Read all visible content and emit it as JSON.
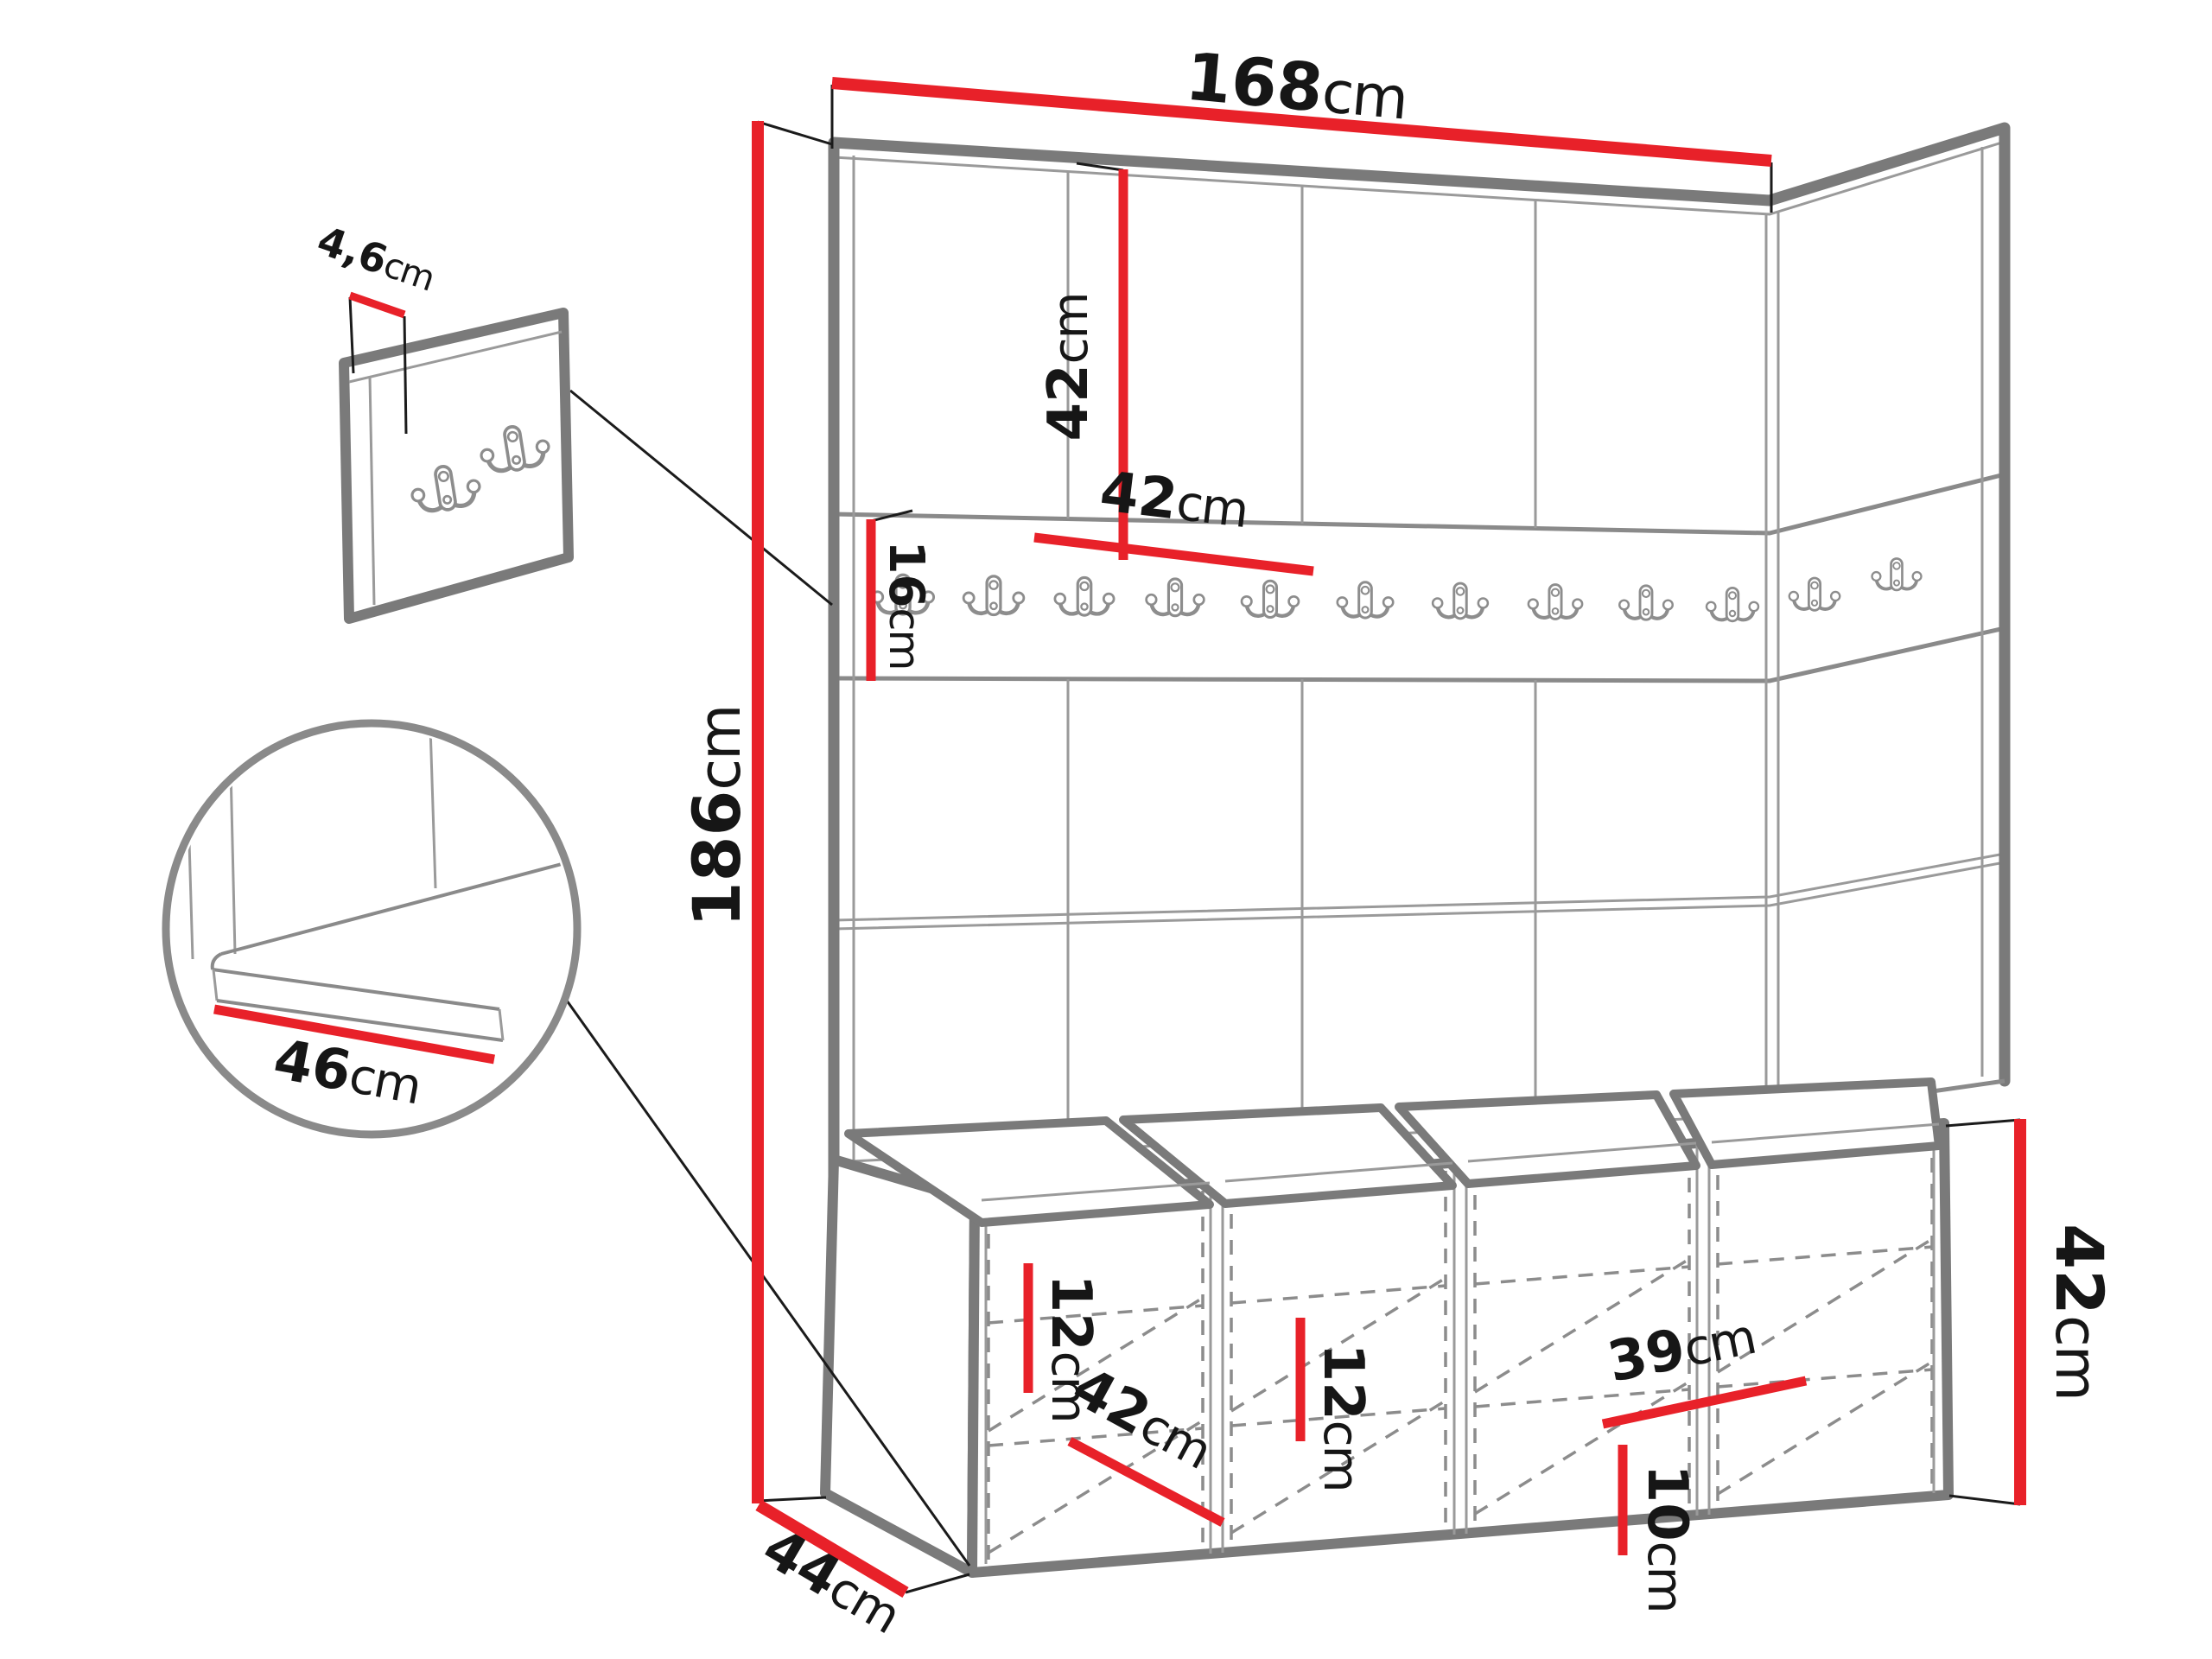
{
  "diagram": {
    "type": "furniture-dimension-drawing",
    "subject": "hallway wardrobe wall panel set with coat-hook rail and shoe storage bench",
    "colors": {
      "background": "#ffffff",
      "dimension_red": "#e82129",
      "outline_gray": "#7a7a7a",
      "line_gray": "#9a9a9a",
      "dashed_gray": "#8c8c8c",
      "text": "#161616"
    },
    "dimensions": {
      "total_width": {
        "value": "168",
        "unit": "cm"
      },
      "total_height": {
        "value": "186",
        "unit": "cm"
      },
      "panel_square_height": {
        "value": "42",
        "unit": "cm"
      },
      "panel_square_width": {
        "value": "42",
        "unit": "cm"
      },
      "hook_rail_height": {
        "value": "16",
        "unit": "cm"
      },
      "hook_panel_thickness": {
        "value": "4,6",
        "unit": "cm"
      },
      "seat_depth": {
        "value": "46",
        "unit": "cm"
      },
      "shelf_spacing_left": {
        "value": "12",
        "unit": "cm"
      },
      "door_width": {
        "value": "42",
        "unit": "cm"
      },
      "shelf_spacing_mid": {
        "value": "12",
        "unit": "cm"
      },
      "compartment_width": {
        "value": "39",
        "unit": "cm"
      },
      "bottom_clearance": {
        "value": "10",
        "unit": "cm"
      },
      "bench_height": {
        "value": "42",
        "unit": "cm"
      },
      "bench_depth": {
        "value": "44",
        "unit": "cm"
      }
    },
    "components": {
      "wall_panel_columns": 4,
      "rail_hooks_front": 10,
      "rail_hooks_side": 2,
      "detail_panel_hooks": 2,
      "bench_compartments": 4,
      "bench_cushions": 4
    }
  }
}
